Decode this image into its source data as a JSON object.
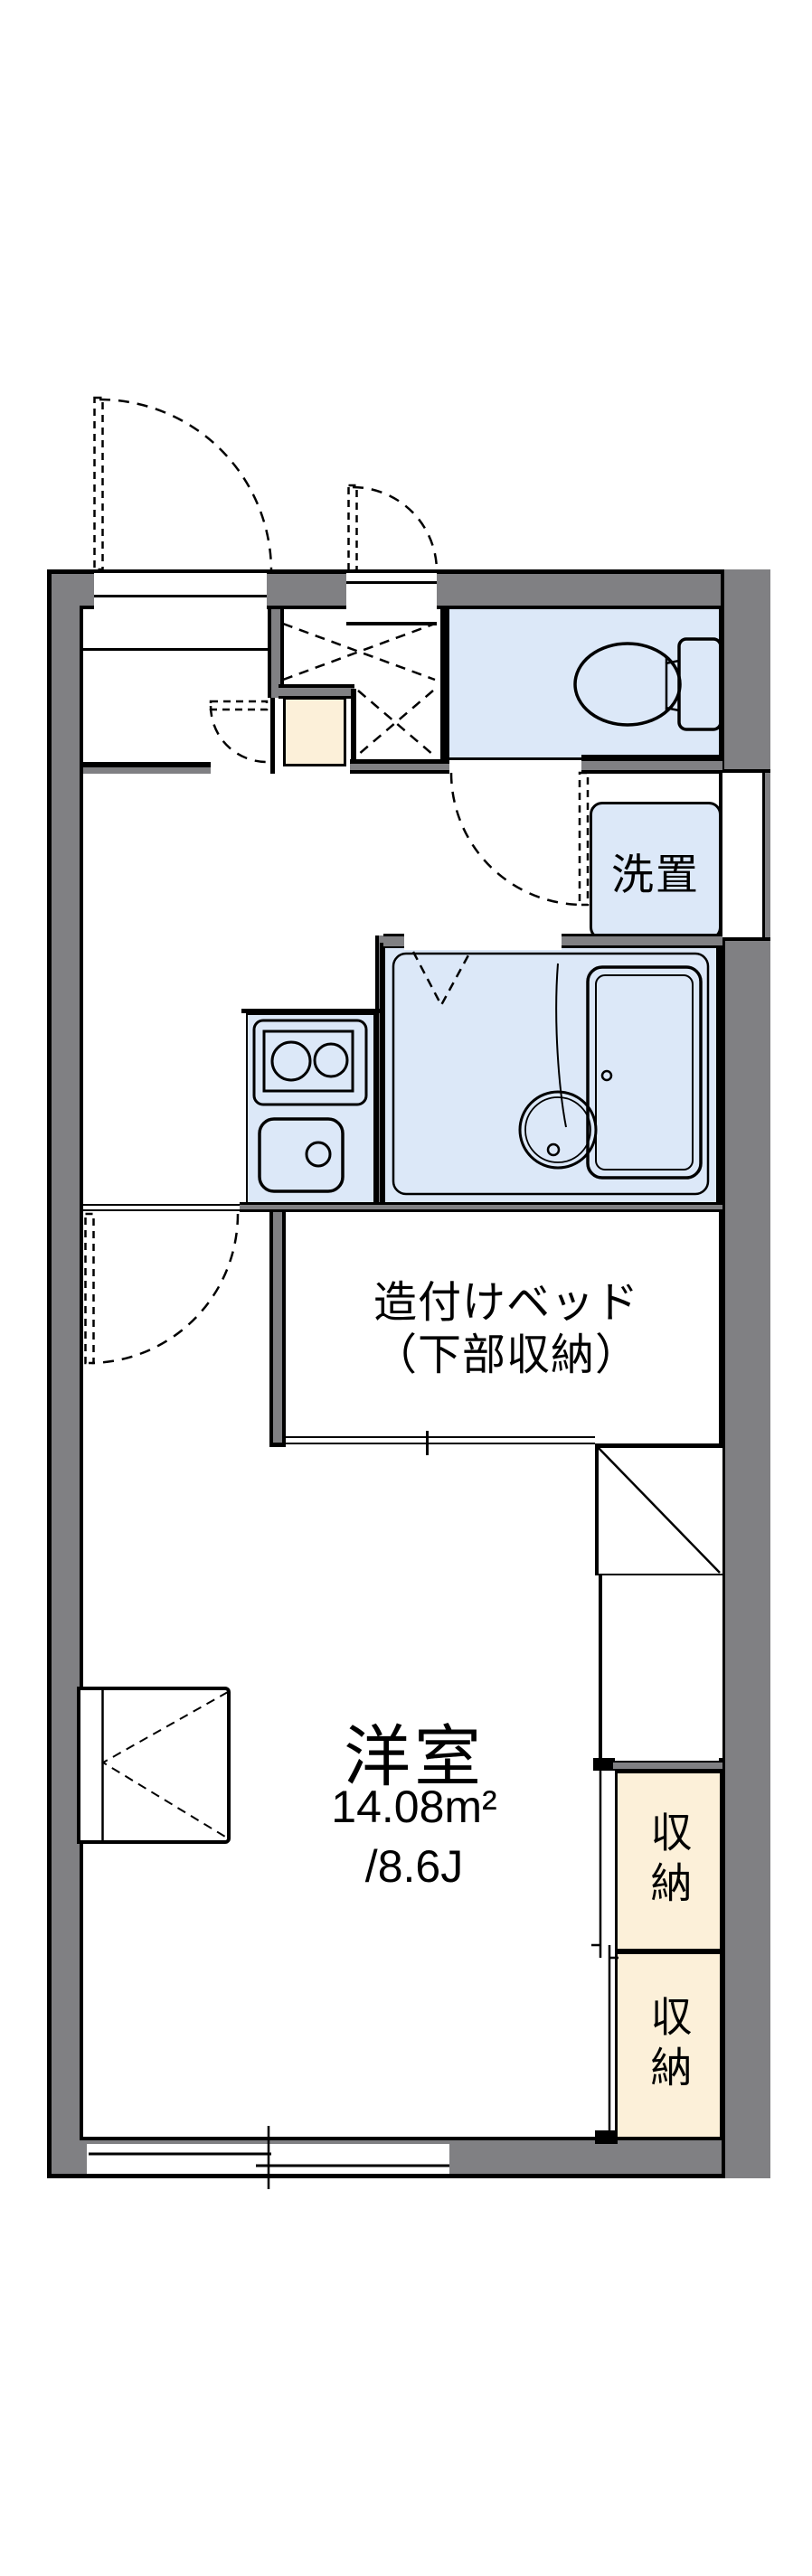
{
  "floorplan": {
    "labels": {
      "bed_line1": "造付けベッド",
      "bed_line2": "（下部収納）",
      "washer": "洗置",
      "room": "洋室",
      "area_sqm": "14.08m²",
      "area_tatami": "/8.6J",
      "storage_top": "収納",
      "storage_bottom": "収納"
    },
    "colors": {
      "wall_gray": "#808083",
      "fixture_blue": "#dce8f8",
      "storage_beige": "#fcf0d9",
      "line_black": "#000000",
      "background": "#ffffff"
    },
    "fixtures": [
      "toilet",
      "bathtub",
      "washbasin",
      "two-burner-stove",
      "kitchen-sink",
      "washing-machine-space",
      "built-in-bed",
      "storage-closet",
      "storage-closet",
      "entrance-door",
      "sub-door",
      "shoe-cabinet",
      "bay-window",
      "sliding-window"
    ]
  }
}
